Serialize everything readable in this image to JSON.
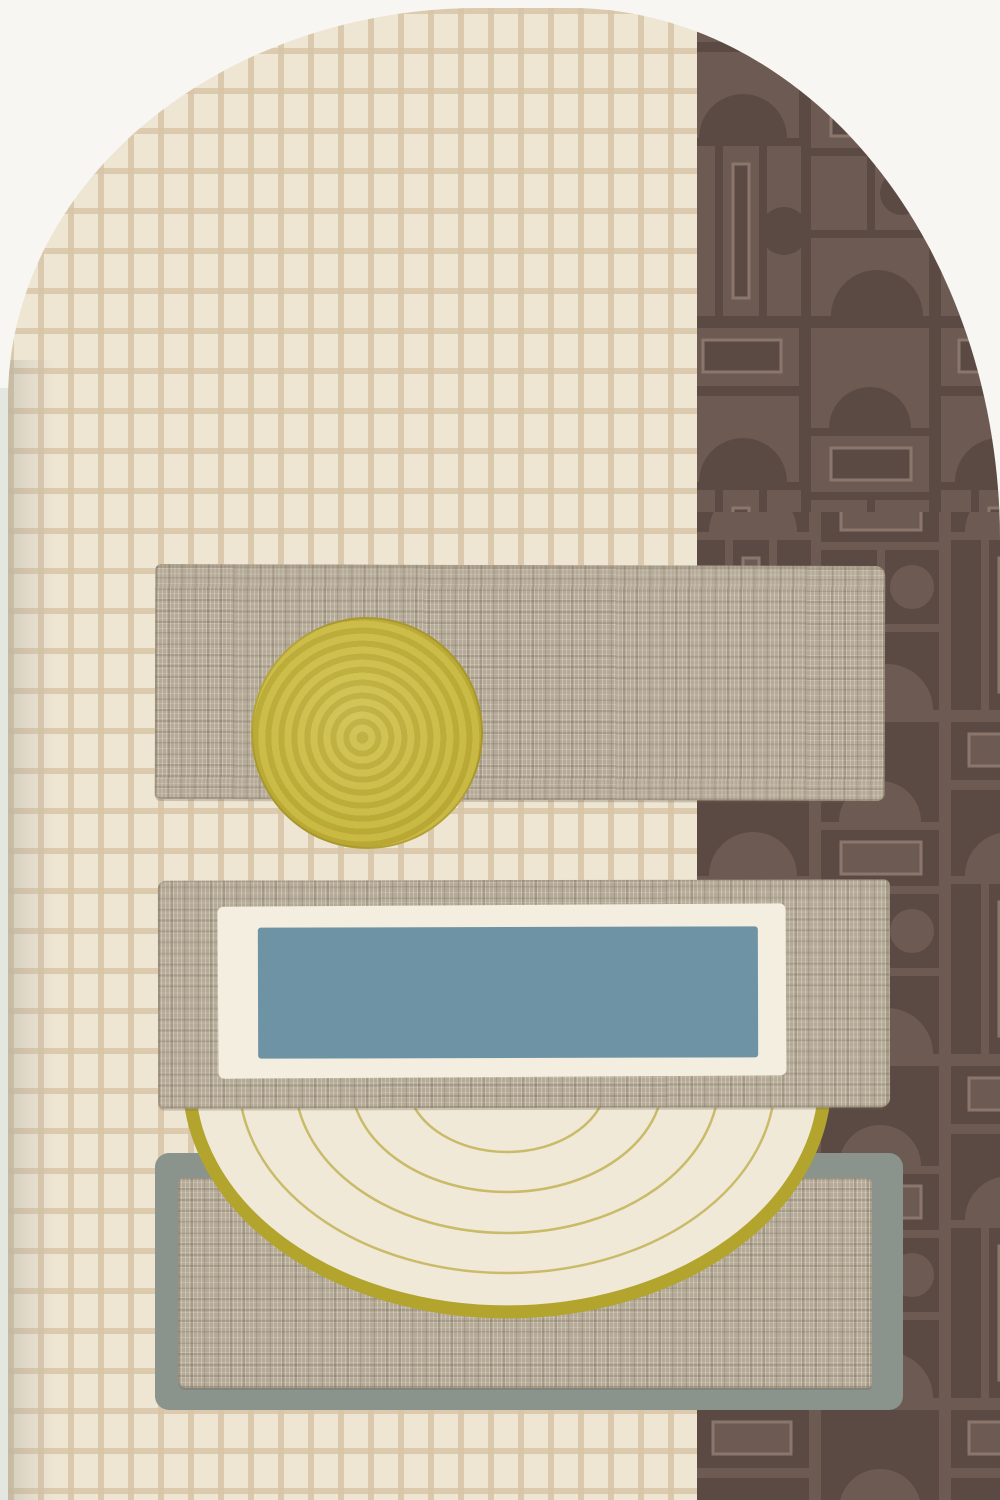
{
  "artwork": {
    "kind": "abstract-geometric-collage",
    "orientation": "portrait",
    "canvas": {
      "width": 1000,
      "height": 1500
    }
  },
  "palette": {
    "page_bg": "#f7f6f2",
    "left_strip": "#e4e6e0",
    "arch_cell": "#eee5d3",
    "arch_grout": "#d8c4a6",
    "brown_dark": "#5b4a43",
    "brown_light": "#6d5a53",
    "brown_line": "#8b766c",
    "bar_taupe": "#b5aa98",
    "circle_mustard": "#c2b138",
    "circle_swirl": "#cdbf52",
    "blue_panel": "#6e93a4",
    "frame_cream": "#f3eedf",
    "semi_cream": "#f0e9d7",
    "semi_line": "#c9bb69",
    "olive_rim": "#b2a42c",
    "sage": "#8a948c"
  },
  "shapes": {
    "arch": {
      "x": 8,
      "y": 8,
      "w": 992,
      "h": 1492,
      "top_left_radius": [
        472,
        392
      ],
      "top_right_radius": [
        430,
        532
      ]
    },
    "brown_column": {
      "x": 697,
      "w": 303,
      "tone_split_y": 512
    },
    "bar_top": {
      "x": 155,
      "y": 565,
      "w": 730,
      "h": 235
    },
    "mustard_circle": {
      "cx": 367,
      "cy": 733,
      "r": 116
    },
    "bar_middle": {
      "x": 158,
      "y": 880,
      "w": 732,
      "h": 228
    },
    "cream_frame": {
      "x": 218,
      "y": 905,
      "w": 568,
      "h": 172
    },
    "blue_panel": {
      "x": 258,
      "y": 927,
      "w": 500,
      "h": 131
    },
    "semicircle": {
      "cx": 507,
      "flat_top_y": 1108,
      "rx": 322,
      "ry": 232,
      "rim_width": 13,
      "inner_arc_count": 4
    },
    "sage_frame": {
      "x": 155,
      "y": 1153,
      "w": 748,
      "h": 257
    },
    "sage_inner_bar": {
      "x": 178,
      "y": 1178,
      "w": 694,
      "h": 210
    }
  }
}
